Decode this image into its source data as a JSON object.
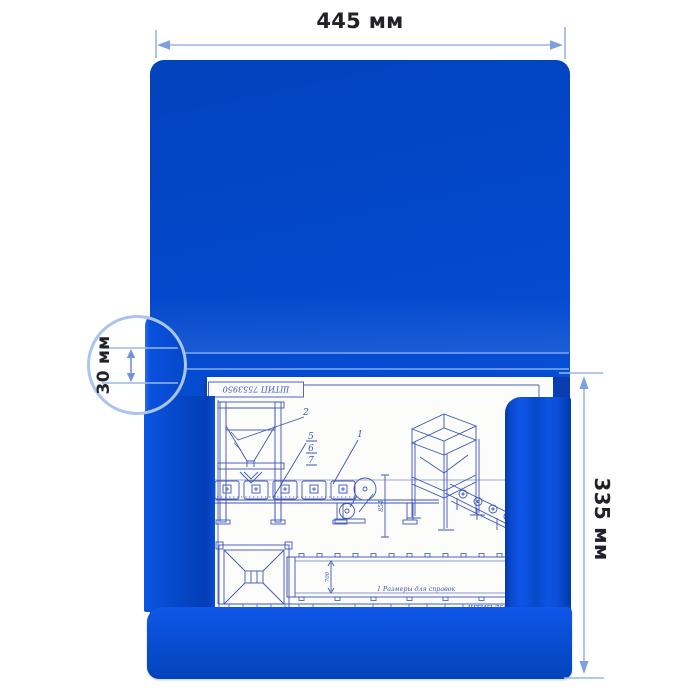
{
  "annotations": {
    "width": "445 мм",
    "height": "335 мм",
    "spine": "30 мм"
  },
  "blueprint": {
    "stamp": "ШТИП 7553950",
    "title_block": "ШТИП 7553",
    "note": "1 Размеры для справок",
    "callout_1": "1",
    "callout_2": "2",
    "callout_5": "5",
    "callout_6": "6",
    "callout_7": "7",
    "dim_height": "854",
    "dim_width": "700"
  },
  "colors": {
    "folder_blue": "#0449cc",
    "folder_blue_dark": "#0239ac",
    "folder_blue_light": "#0f57e8",
    "dimension_line": "#9ab5e6",
    "label_text": "#212329",
    "blueprint_line": "#3d55b8"
  }
}
